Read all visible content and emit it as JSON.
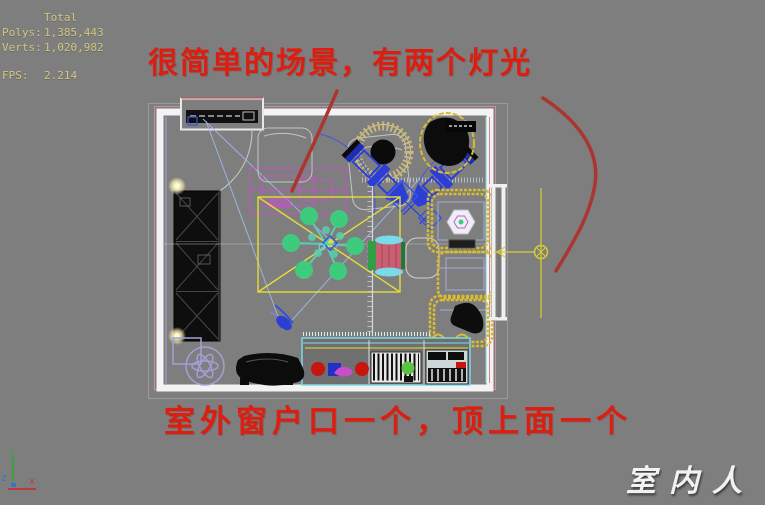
{
  "colors": {
    "background": "#7e7e7e",
    "stats-text": "#d0c77c",
    "annotation-red": "#dc1e10",
    "sketch-red": "#ab3530",
    "wall-white": "#f2f2f2",
    "light-yellow": "#ddd42e",
    "wireframe-blue": "#3346d2",
    "chandelier-green": "#3ecb7e",
    "cabinet-cyan": "#7adbe8",
    "sofa-yellow": "#d9bd2e",
    "rug-lavender": "#a49fd8",
    "watermark-white": "#f2f2f2",
    "axis-x-red": "#c03a34",
    "axis-y-green": "#3f9f3f",
    "axis-z-blue": "#3b6fd8"
  },
  "viewport": {
    "stats": {
      "total": "Total",
      "rows": [
        {
          "label": "Polys:",
          "value": "1,385,443"
        },
        {
          "label": "Verts:",
          "value": "1,020,982"
        }
      ],
      "fps": {
        "label": "FPS:",
        "value": "2.214"
      }
    },
    "axis": {
      "x": "x",
      "y": "y",
      "z": "z"
    }
  },
  "annotations": {
    "top": "很简单的场景，有两个灯光",
    "bottom": "室外窗户口一个，顶上面一个"
  },
  "watermark": {
    "text": "室内人"
  }
}
